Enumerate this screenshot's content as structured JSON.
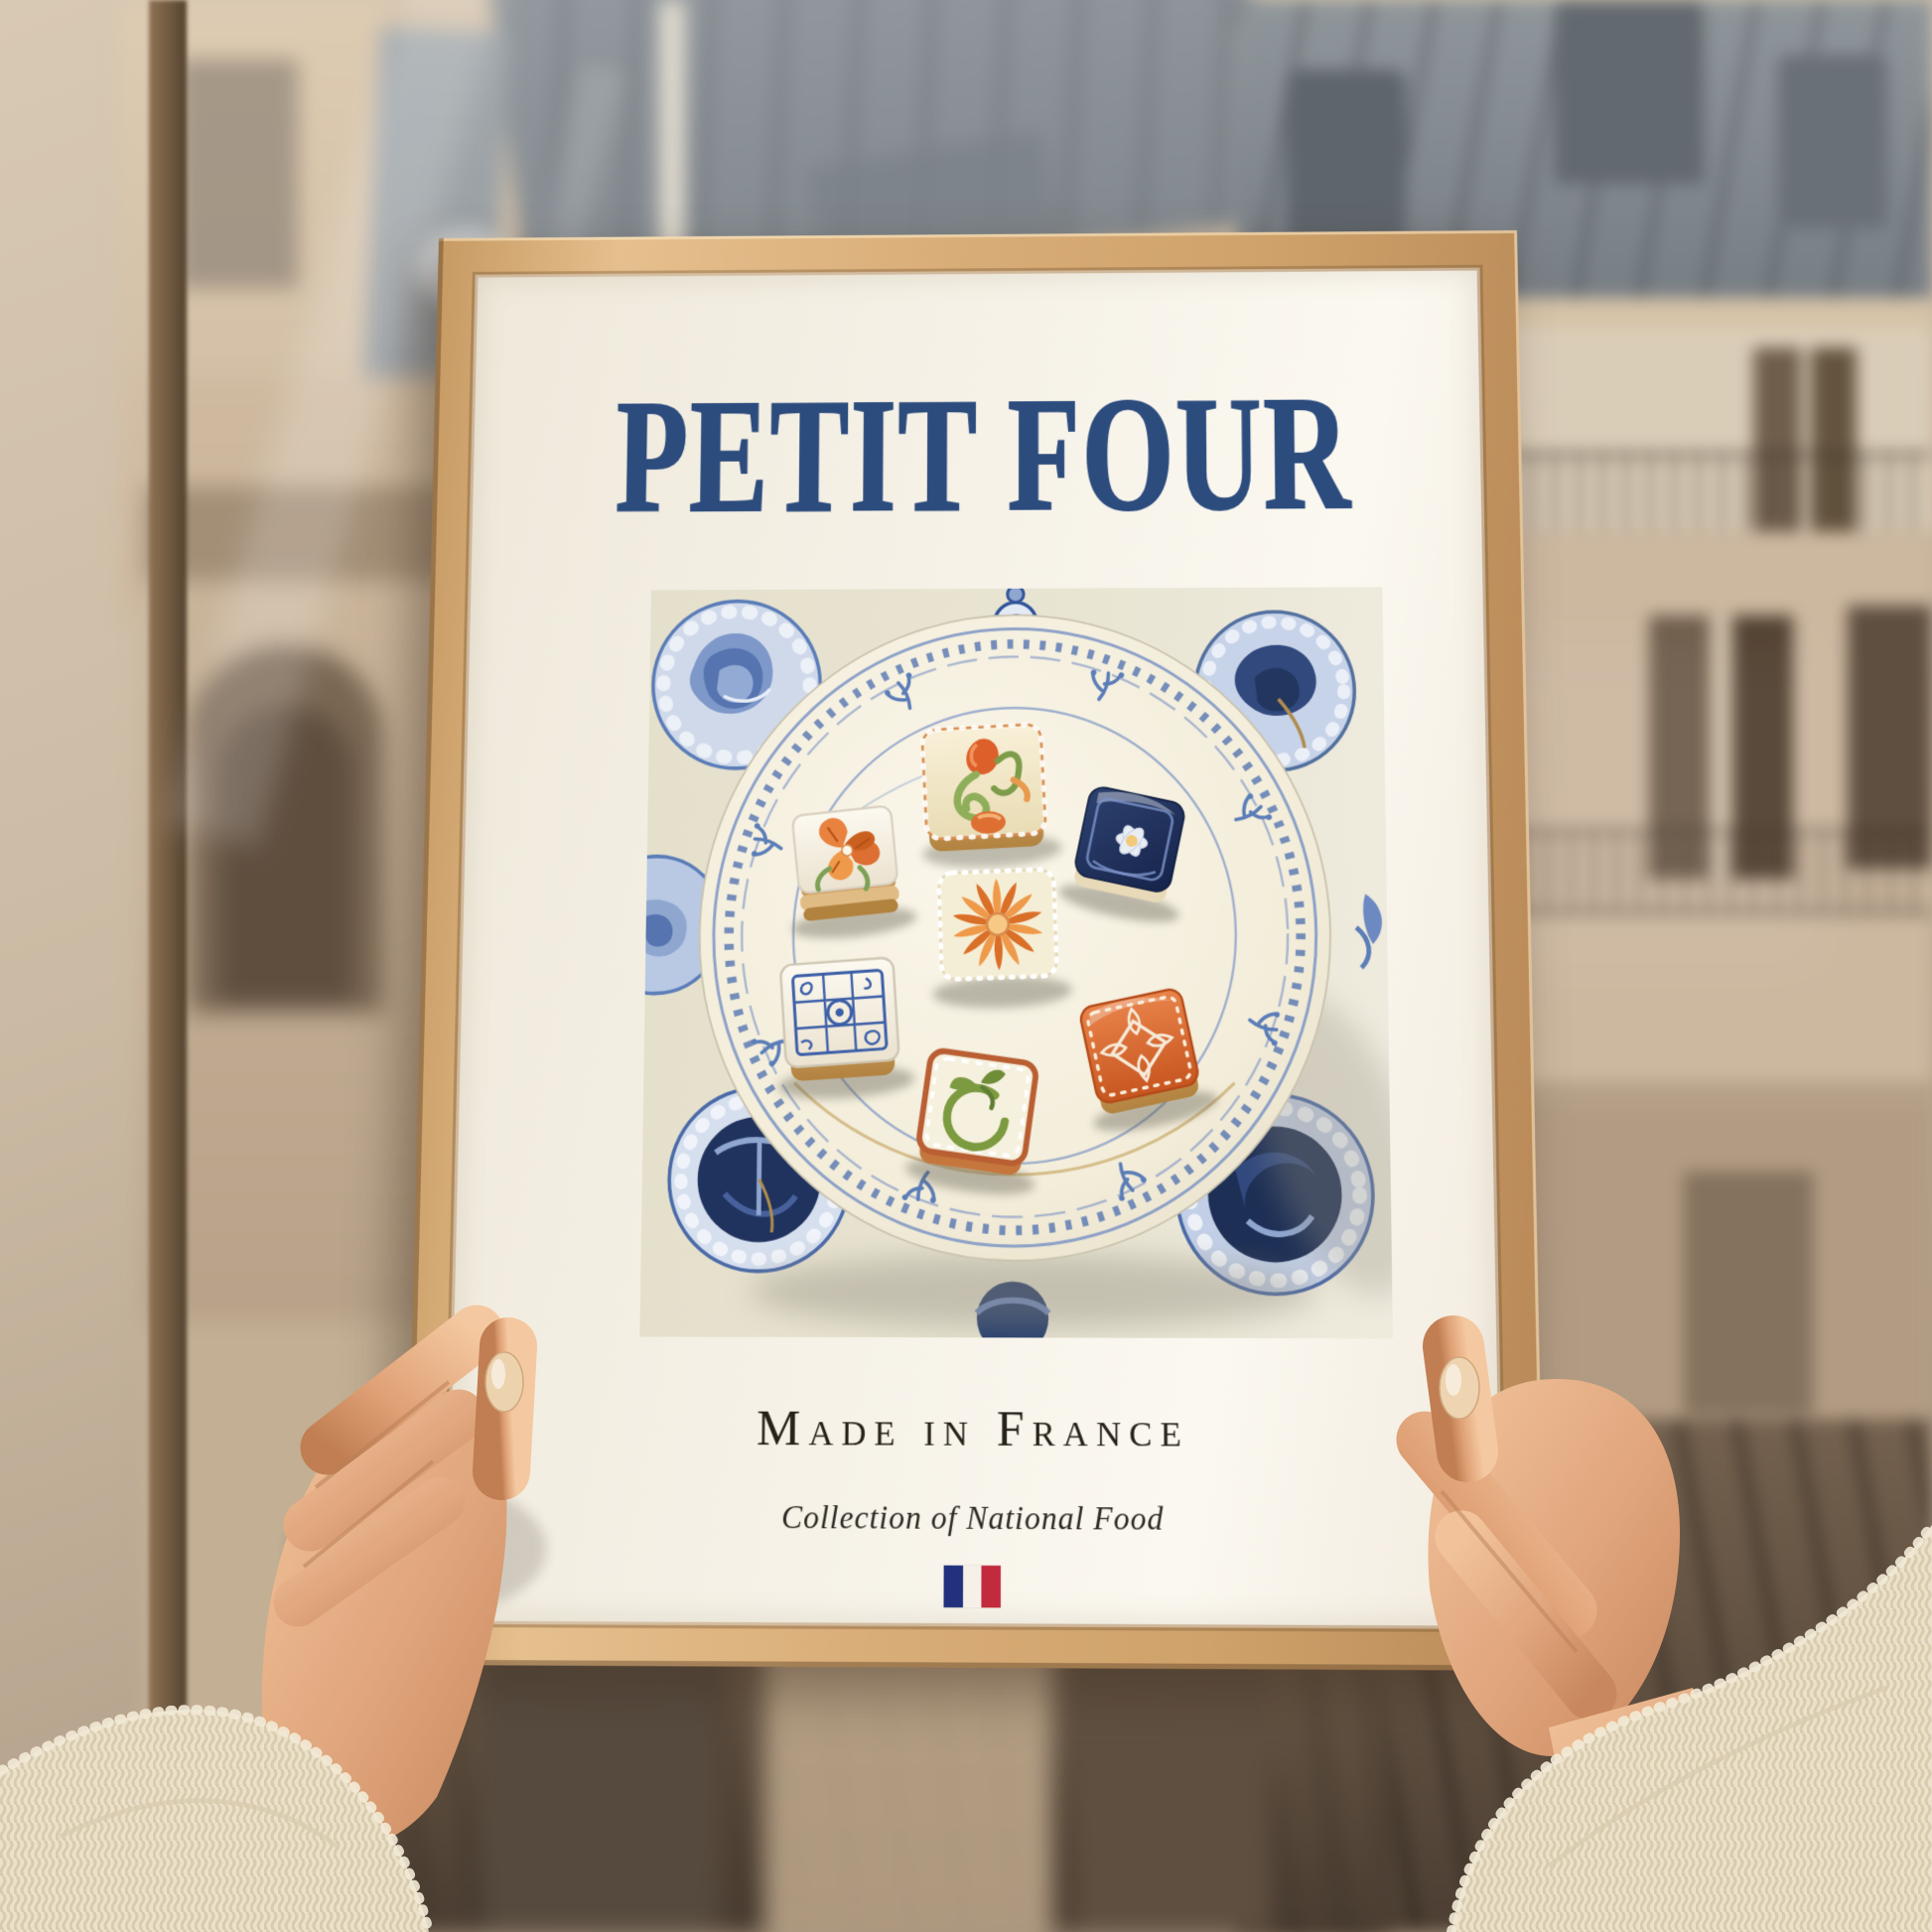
{
  "poster": {
    "title": "PETIT FOUR",
    "subtitle": "Made in France",
    "caption": "Collection of National Food",
    "flag_icon": "french-flag",
    "illustration": {
      "subject": "seven iced petit fours on a blue-and-white delft plate",
      "petit_fours": [
        "tulip-swirl",
        "orange-poppy",
        "navy-white-flower",
        "orange-dahlia",
        "blue-azulejo",
        "green-ring",
        "orange-lace"
      ],
      "ornaments": [
        "delft-medallions",
        "delft-crown",
        "delft-bowls",
        "floral-sprigs"
      ]
    }
  },
  "scene": {
    "setting_icons": [
      "paris-haussmann-buildings",
      "window-frame",
      "hands-holding-frame",
      "knit-sweater-sleeves"
    ]
  },
  "colors": {
    "title-navy": "#2d4c7e",
    "paper": "#f6f2e8",
    "frame-wood": "#d9ad78",
    "delft-blue": "#3d5fa4",
    "delft-navy": "#1f3157",
    "accent-orange": "#e07a33",
    "flag-blue": "#21317d",
    "flag-white": "#f5f1e8",
    "flag-red": "#c22a3d"
  }
}
